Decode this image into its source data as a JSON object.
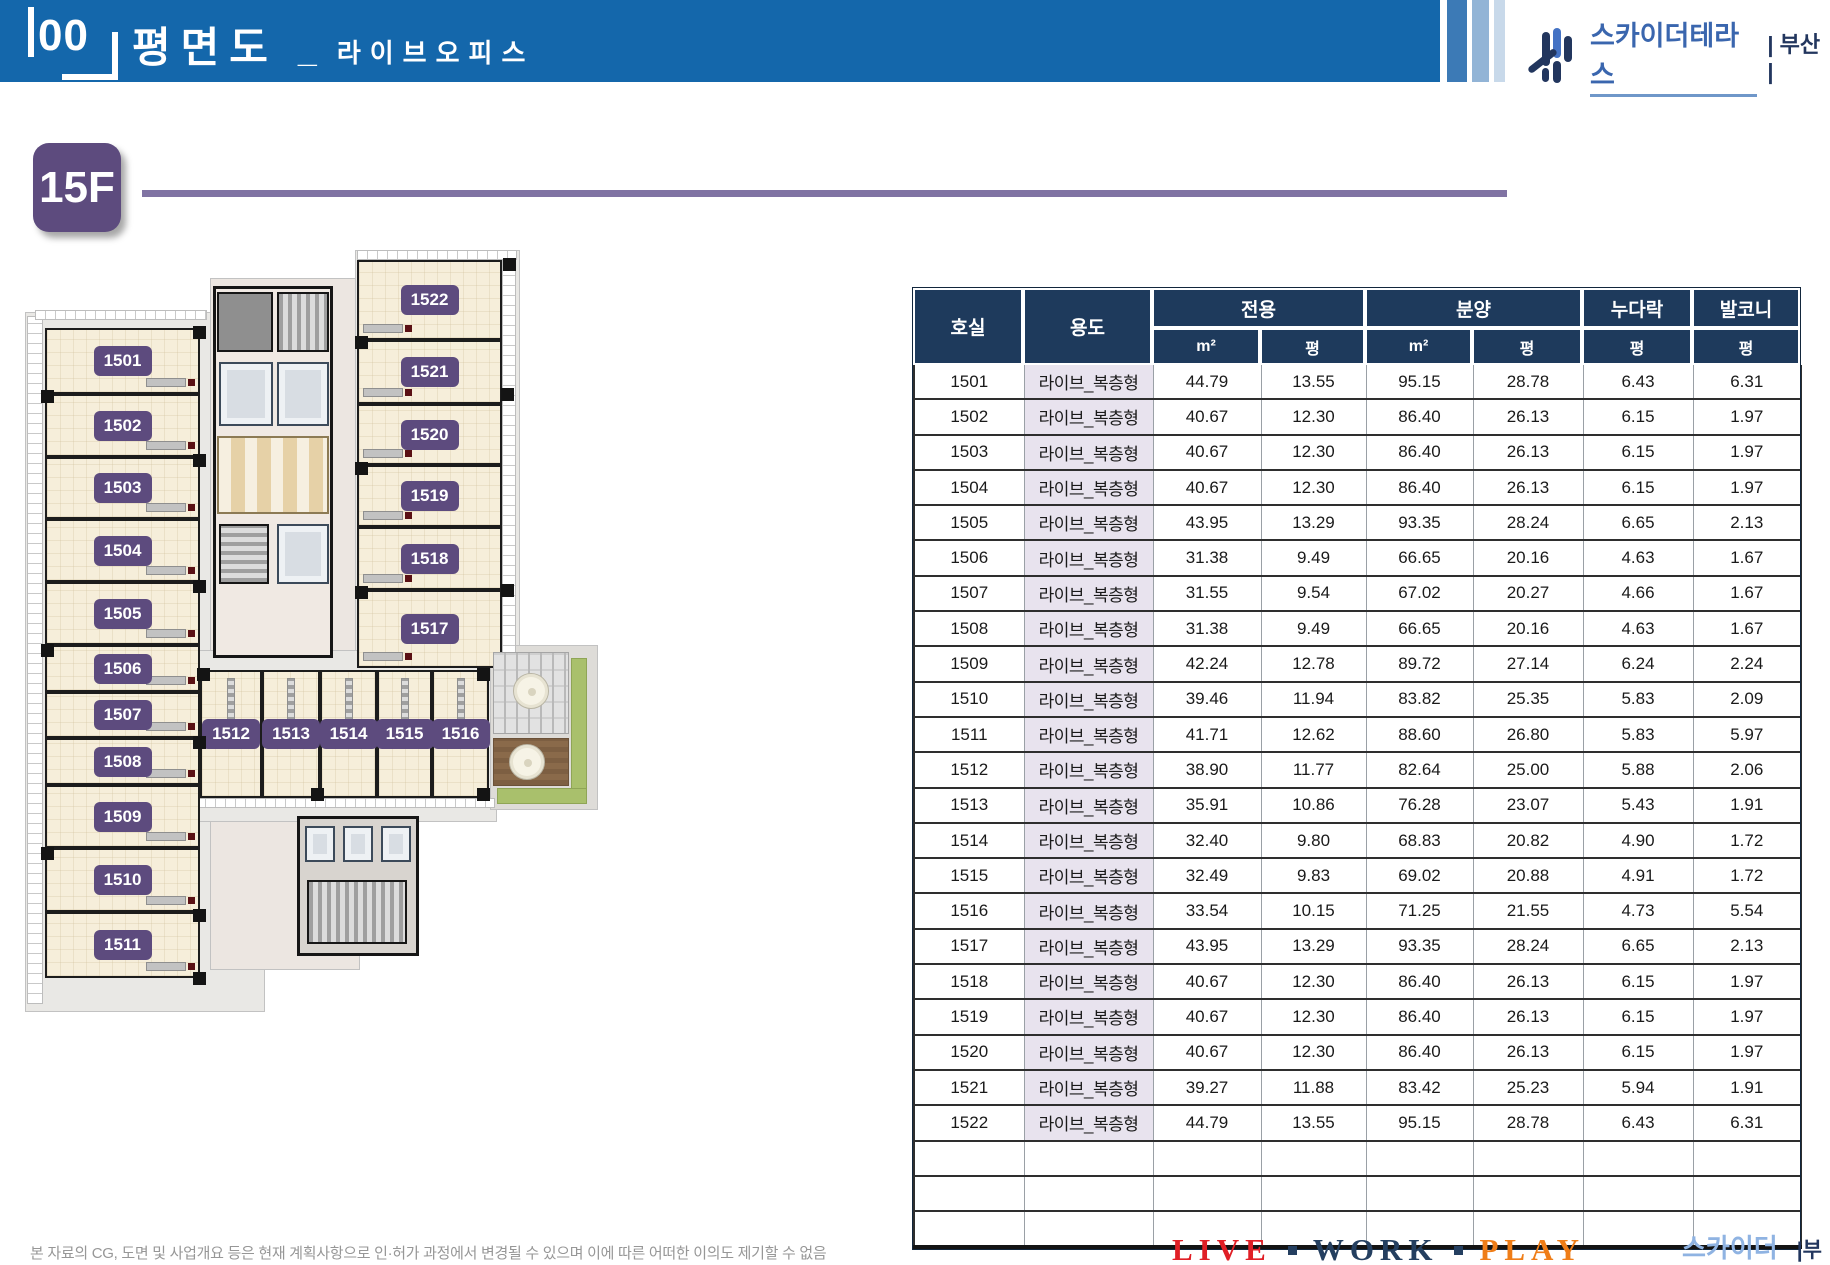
{
  "header": {
    "index_label": "00",
    "title": "평면도",
    "separator": "_",
    "subtitle": "라이브오피스"
  },
  "brand": {
    "name": "스카이더테라스",
    "region_header": "| 부산 |",
    "region_footer": "|부산|"
  },
  "floor_badge": {
    "label": "15F"
  },
  "floor_plan": {
    "rooms": [
      "1501",
      "1502",
      "1503",
      "1504",
      "1505",
      "1506",
      "1507",
      "1508",
      "1509",
      "1510",
      "1511",
      "1512",
      "1513",
      "1514",
      "1515",
      "1516",
      "1517",
      "1518",
      "1519",
      "1520",
      "1521",
      "1522"
    ]
  },
  "table": {
    "headers": {
      "room": "호실",
      "use": "용도",
      "exclusive": "전용",
      "supply": "분양",
      "loft": "누다락",
      "balcony": "발코니",
      "sqm": "m²",
      "pyeong": "평"
    },
    "rows": [
      {
        "room": "1501",
        "use": "라이브_복층형",
        "ex_sqm": "44.79",
        "ex_py": "13.55",
        "sp_sqm": "95.15",
        "sp_py": "28.78",
        "loft": "6.43",
        "balcony": "6.31"
      },
      {
        "room": "1502",
        "use": "라이브_복층형",
        "ex_sqm": "40.67",
        "ex_py": "12.30",
        "sp_sqm": "86.40",
        "sp_py": "26.13",
        "loft": "6.15",
        "balcony": "1.97"
      },
      {
        "room": "1503",
        "use": "라이브_복층형",
        "ex_sqm": "40.67",
        "ex_py": "12.30",
        "sp_sqm": "86.40",
        "sp_py": "26.13",
        "loft": "6.15",
        "balcony": "1.97"
      },
      {
        "room": "1504",
        "use": "라이브_복층형",
        "ex_sqm": "40.67",
        "ex_py": "12.30",
        "sp_sqm": "86.40",
        "sp_py": "26.13",
        "loft": "6.15",
        "balcony": "1.97"
      },
      {
        "room": "1505",
        "use": "라이브_복층형",
        "ex_sqm": "43.95",
        "ex_py": "13.29",
        "sp_sqm": "93.35",
        "sp_py": "28.24",
        "loft": "6.65",
        "balcony": "2.13"
      },
      {
        "room": "1506",
        "use": "라이브_복층형",
        "ex_sqm": "31.38",
        "ex_py": "9.49",
        "sp_sqm": "66.65",
        "sp_py": "20.16",
        "loft": "4.63",
        "balcony": "1.67"
      },
      {
        "room": "1507",
        "use": "라이브_복층형",
        "ex_sqm": "31.55",
        "ex_py": "9.54",
        "sp_sqm": "67.02",
        "sp_py": "20.27",
        "loft": "4.66",
        "balcony": "1.67"
      },
      {
        "room": "1508",
        "use": "라이브_복층형",
        "ex_sqm": "31.38",
        "ex_py": "9.49",
        "sp_sqm": "66.65",
        "sp_py": "20.16",
        "loft": "4.63",
        "balcony": "1.67"
      },
      {
        "room": "1509",
        "use": "라이브_복층형",
        "ex_sqm": "42.24",
        "ex_py": "12.78",
        "sp_sqm": "89.72",
        "sp_py": "27.14",
        "loft": "6.24",
        "balcony": "2.24"
      },
      {
        "room": "1510",
        "use": "라이브_복층형",
        "ex_sqm": "39.46",
        "ex_py": "11.94",
        "sp_sqm": "83.82",
        "sp_py": "25.35",
        "loft": "5.83",
        "balcony": "2.09"
      },
      {
        "room": "1511",
        "use": "라이브_복층형",
        "ex_sqm": "41.71",
        "ex_py": "12.62",
        "sp_sqm": "88.60",
        "sp_py": "26.80",
        "loft": "5.83",
        "balcony": "5.97"
      },
      {
        "room": "1512",
        "use": "라이브_복층형",
        "ex_sqm": "38.90",
        "ex_py": "11.77",
        "sp_sqm": "82.64",
        "sp_py": "25.00",
        "loft": "5.88",
        "balcony": "2.06"
      },
      {
        "room": "1513",
        "use": "라이브_복층형",
        "ex_sqm": "35.91",
        "ex_py": "10.86",
        "sp_sqm": "76.28",
        "sp_py": "23.07",
        "loft": "5.43",
        "balcony": "1.91"
      },
      {
        "room": "1514",
        "use": "라이브_복층형",
        "ex_sqm": "32.40",
        "ex_py": "9.80",
        "sp_sqm": "68.83",
        "sp_py": "20.82",
        "loft": "4.90",
        "balcony": "1.72"
      },
      {
        "room": "1515",
        "use": "라이브_복층형",
        "ex_sqm": "32.49",
        "ex_py": "9.83",
        "sp_sqm": "69.02",
        "sp_py": "20.88",
        "loft": "4.91",
        "balcony": "1.72"
      },
      {
        "room": "1516",
        "use": "라이브_복층형",
        "ex_sqm": "33.54",
        "ex_py": "10.15",
        "sp_sqm": "71.25",
        "sp_py": "21.55",
        "loft": "4.73",
        "balcony": "5.54"
      },
      {
        "room": "1517",
        "use": "라이브_복층형",
        "ex_sqm": "43.95",
        "ex_py": "13.29",
        "sp_sqm": "93.35",
        "sp_py": "28.24",
        "loft": "6.65",
        "balcony": "2.13"
      },
      {
        "room": "1518",
        "use": "라이브_복층형",
        "ex_sqm": "40.67",
        "ex_py": "12.30",
        "sp_sqm": "86.40",
        "sp_py": "26.13",
        "loft": "6.15",
        "balcony": "1.97"
      },
      {
        "room": "1519",
        "use": "라이브_복층형",
        "ex_sqm": "40.67",
        "ex_py": "12.30",
        "sp_sqm": "86.40",
        "sp_py": "26.13",
        "loft": "6.15",
        "balcony": "1.97"
      },
      {
        "room": "1520",
        "use": "라이브_복층형",
        "ex_sqm": "40.67",
        "ex_py": "12.30",
        "sp_sqm": "86.40",
        "sp_py": "26.13",
        "loft": "6.15",
        "balcony": "1.97"
      },
      {
        "room": "1521",
        "use": "라이브_복층형",
        "ex_sqm": "39.27",
        "ex_py": "11.88",
        "sp_sqm": "83.42",
        "sp_py": "25.23",
        "loft": "5.94",
        "balcony": "1.91"
      },
      {
        "room": "1522",
        "use": "라이브_복층형",
        "ex_sqm": "44.79",
        "ex_py": "13.55",
        "sp_sqm": "95.15",
        "sp_py": "28.78",
        "loft": "6.43",
        "balcony": "6.31"
      }
    ],
    "empty_row_count": 3
  },
  "footer": {
    "disclaimer": "본 자료의 CG, 도면 및 사업개요 등은 현재 계획사항으로 인·허가 과정에서 변경될 수 있으며 이에 따른 어떠한 이의도 제기할 수 없음",
    "slogan": {
      "live": "LIVE",
      "work": "WORK",
      "play": "PLAY"
    }
  },
  "colors": {
    "header_blue": "#1467ab",
    "table_header_navy": "#1e3a5c",
    "badge_purple": "#5d4b7e",
    "use_cell_lavender": "#e8e3ee",
    "slogan_red": "#e01f26",
    "slogan_navy": "#243f60",
    "slogan_orange": "#ef7d17"
  }
}
